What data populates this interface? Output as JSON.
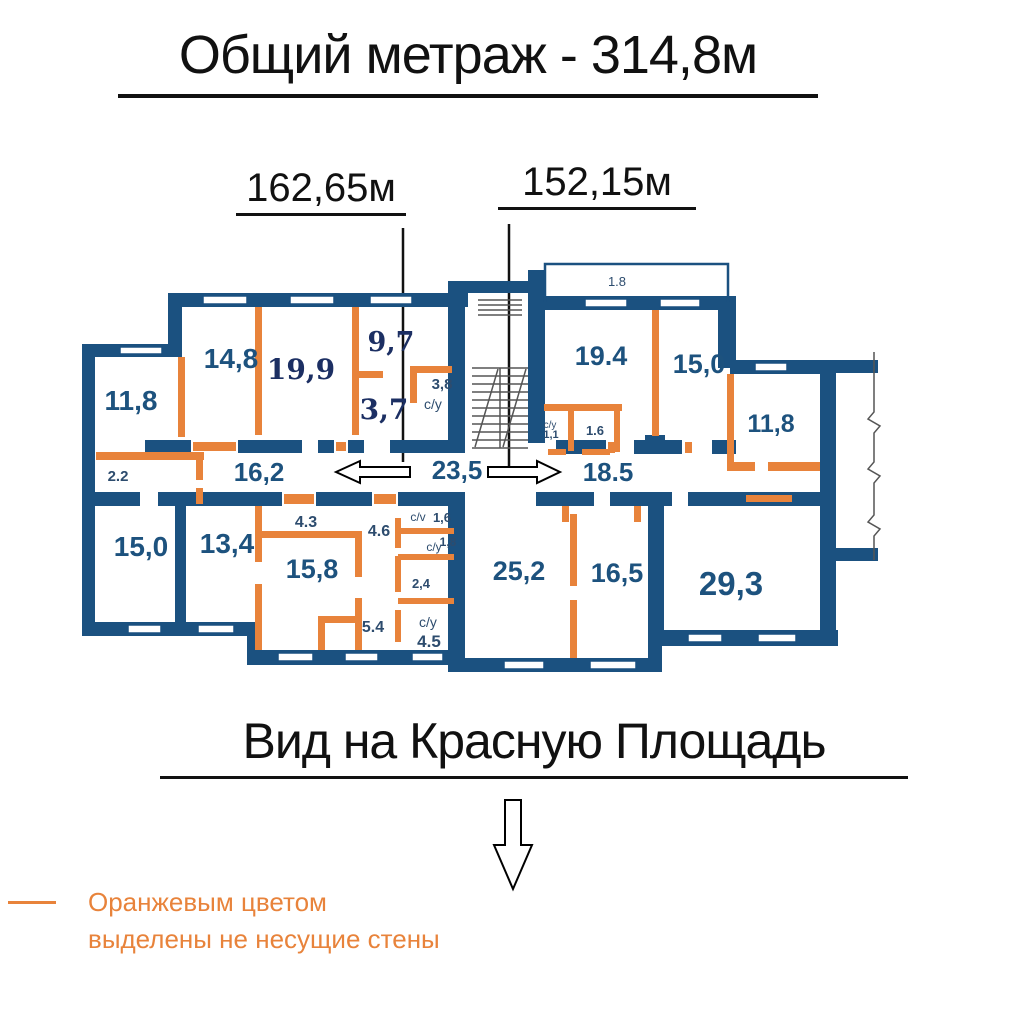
{
  "title": {
    "text": "Общий метраж - 314,8м"
  },
  "sections": {
    "left_area": "162,65м",
    "right_area": "152,15м"
  },
  "caption": {
    "text": "Вид на Красную Площадь"
  },
  "legend": {
    "line1": "Оранжевым цветом",
    "line2": "выделены не несущие стены"
  },
  "colors": {
    "wall_blue": "#1b5180",
    "partition_orange": "#e8833b",
    "label_blue": "#1d527e",
    "label_navy": "#1c2f63"
  },
  "rooms": [
    {
      "id": "room-11-8-left",
      "label": "11,8"
    },
    {
      "id": "room-14-8",
      "label": "14,8"
    },
    {
      "id": "room-19-9",
      "label": "19,9"
    },
    {
      "id": "room-9-7",
      "label": "9,7"
    },
    {
      "id": "room-3-7",
      "label": "3,7"
    },
    {
      "id": "room-3-8",
      "label": "3,8"
    },
    {
      "id": "wc-top-left",
      "label": "с/у"
    },
    {
      "id": "balcony-2-2",
      "label": "2.2"
    },
    {
      "id": "hall-16-2",
      "label": "16,2"
    },
    {
      "id": "hall-23-5",
      "label": "23,5"
    },
    {
      "id": "room-15-0-bottom-left",
      "label": "15,0"
    },
    {
      "id": "room-13-4",
      "label": "13,4"
    },
    {
      "id": "hall-4-3",
      "label": "4.3"
    },
    {
      "id": "hall-4-6",
      "label": "4.6"
    },
    {
      "id": "room-15-8",
      "label": "15,8"
    },
    {
      "id": "wc-cv-mid",
      "label": "с/v"
    },
    {
      "id": "wc-1-6-mid",
      "label": "1,6"
    },
    {
      "id": "wc-cu-mid",
      "label": "с/у"
    },
    {
      "id": "wc-1-8-mid",
      "label": "1,8"
    },
    {
      "id": "room-2-4",
      "label": "2,4"
    },
    {
      "id": "hall-5-4",
      "label": "5.4"
    },
    {
      "id": "wc-cu-bottom",
      "label": "с/у"
    },
    {
      "id": "wc-4-5",
      "label": "4.5"
    },
    {
      "id": "balcony-1-8-top",
      "label": "1.8"
    },
    {
      "id": "room-19-4",
      "label": "19.4"
    },
    {
      "id": "room-15-0-top-right",
      "label": "15,0"
    },
    {
      "id": "room-11-8-right",
      "label": "11,8"
    },
    {
      "id": "wc-cu-right",
      "label": "с/у"
    },
    {
      "id": "wc-1-1",
      "label": "1,1"
    },
    {
      "id": "wc-1-6-right",
      "label": "1.6"
    },
    {
      "id": "hall-18-5",
      "label": "18.5"
    },
    {
      "id": "room-25-2",
      "label": "25,2"
    },
    {
      "id": "room-16-5",
      "label": "16,5"
    },
    {
      "id": "room-29-3",
      "label": "29,3"
    }
  ]
}
